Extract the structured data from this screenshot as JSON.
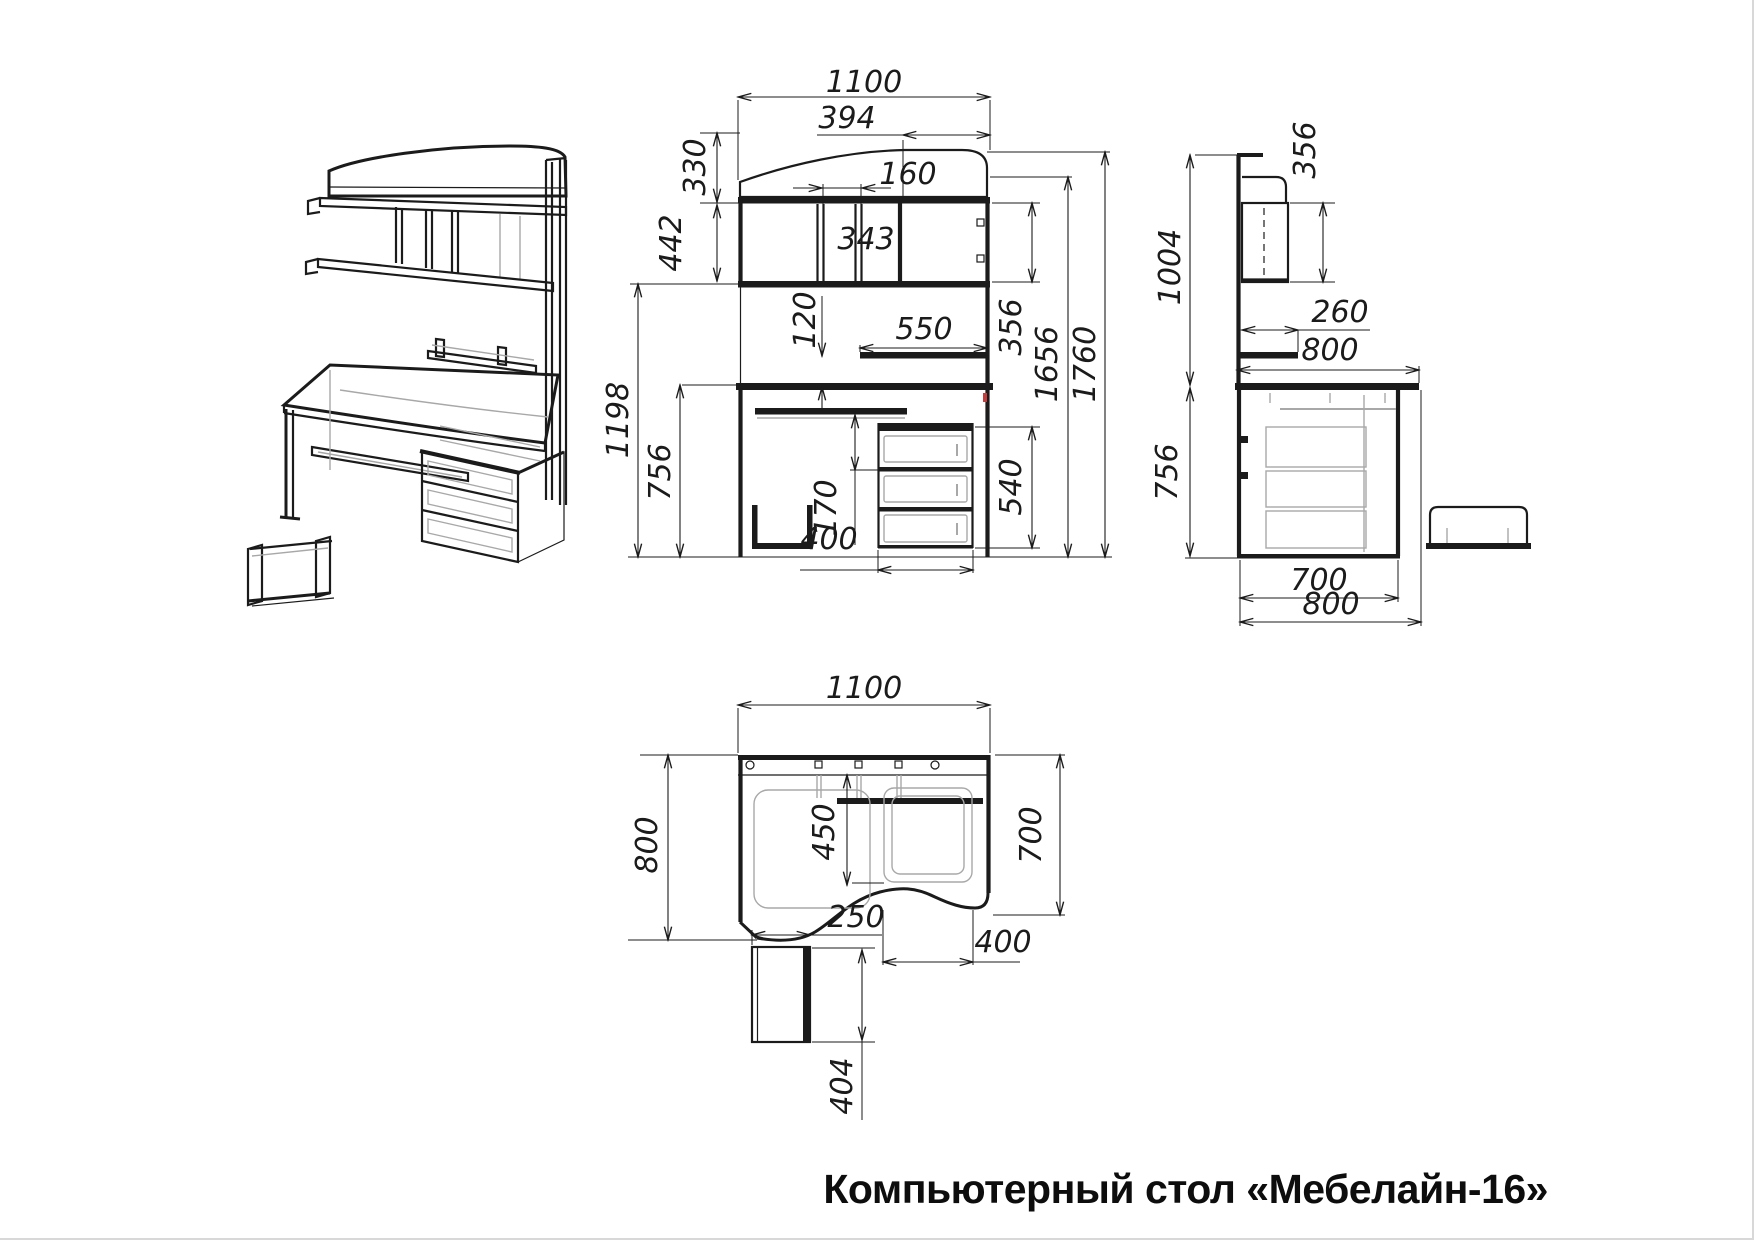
{
  "title": "Компьютерный стол «Мебелайн-16»",
  "front_view": {
    "dims": {
      "width": "1100",
      "shelf_left": "394",
      "niche": "160",
      "top_height": "330",
      "row_height": "442",
      "compartment": "343",
      "gap": "120",
      "shelf_width": "550",
      "row_height_right": "356",
      "body_height": "1656",
      "total_height": "1760",
      "under_hutch": "1198",
      "desk_height": "756",
      "tray_offset": "170",
      "drawer_width": "400",
      "drawer_height": "540"
    }
  },
  "side_view": {
    "dims": {
      "hutch_depth": "356",
      "hutch_height": "1004",
      "shelf_depth": "260",
      "desk_depth": "800",
      "desk_height": "756",
      "cabinet_depth": "700",
      "total_depth": "800"
    }
  },
  "top_view": {
    "dims": {
      "width": "1100",
      "depth": "800",
      "tray_inset": "450",
      "right_depth": "700",
      "chamfer": "250",
      "tray_width": "400",
      "cpu_depth": "404"
    }
  }
}
